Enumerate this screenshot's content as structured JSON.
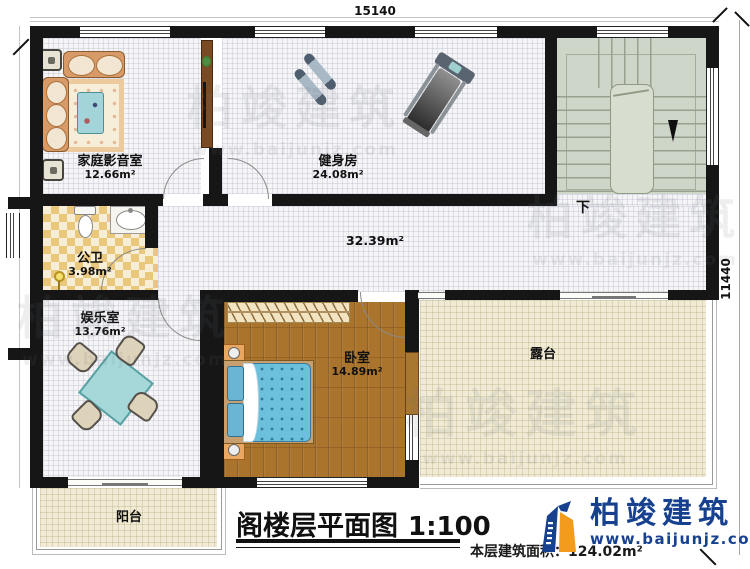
{
  "meta": {
    "title": "阁楼层平面图",
    "scale": "1:100",
    "floor_area_label": "本层建筑面积：",
    "floor_area_value": "124.02m²"
  },
  "dimensions": {
    "width": "15140",
    "height": "11440"
  },
  "rooms": {
    "home_theater": {
      "name": "家庭影音室",
      "area": "12.66m²"
    },
    "gym": {
      "name": "健身房",
      "area": "24.08m²"
    },
    "bathroom": {
      "name": "公卫",
      "area": "3.98m²"
    },
    "entertainment": {
      "name": "娱乐室",
      "area": "13.76m²"
    },
    "bedroom": {
      "name": "卧室",
      "area": "14.89m²"
    },
    "hall": {
      "area": "32.39m²"
    },
    "terrace": {
      "name": "露台"
    },
    "balcony": {
      "name": "阳台"
    }
  },
  "stairs": {
    "direction_label": "下"
  },
  "brand": {
    "name": "柏竣建筑",
    "website": "www.baijunjz.com"
  },
  "watermark": {
    "text": "柏竣建筑",
    "website": "www.baijunjz.com"
  },
  "colors": {
    "wall": "#161616",
    "wood_floor": "#aa742c",
    "terrace_floor": "#f1ebd6",
    "stairs_floor": "#ced5c9",
    "bathroom_tile": "#e9c77c",
    "bed": "#6cc0dc",
    "logo_blue": "#17418f",
    "logo_orange": "#f29b1d"
  }
}
